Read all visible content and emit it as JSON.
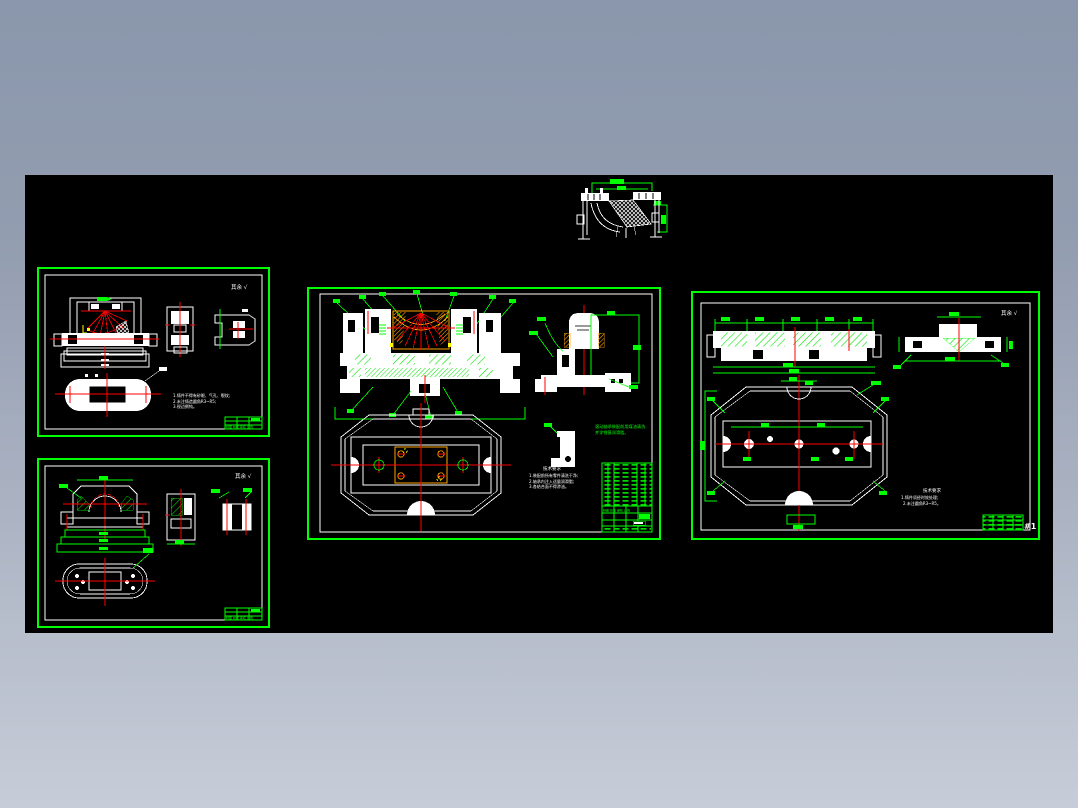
{
  "window": {
    "bg_top": "#8a97ac",
    "bg_bottom": "#c7cdd8",
    "canvas_bg": "#000000"
  },
  "palette": {
    "outline": "#ffffff",
    "dimension": "#00ff00",
    "centerline": "#ff0000",
    "section_accent": "#ffa500",
    "highlight": "#ffff00"
  },
  "common": {
    "mark": "其余 √",
    "title_row": "制图 校核 审核 比例"
  },
  "sheet_a": {
    "notes": [
      "1.铸件不得有砂眼、气孔、裂纹;",
      "2.未注铸造圆角R3~R5;",
      "3.锐边倒钝。"
    ]
  },
  "sheet_c": {
    "green_note": [
      "滚动轴承装配前用煤油清洗",
      "并涂锂基润滑脂。"
    ],
    "notes": [
      "技术要求",
      "1.装配前所有零件清洗干净;",
      "2.轴承内注入适量润滑脂;",
      "3.各结合面不得渗油。"
    ]
  },
  "sheet_d": {
    "notes": [
      "技术要求",
      "1.铸件须经时效处理;",
      "2.未注圆角R3~R5。"
    ],
    "title_mark": "#1"
  }
}
